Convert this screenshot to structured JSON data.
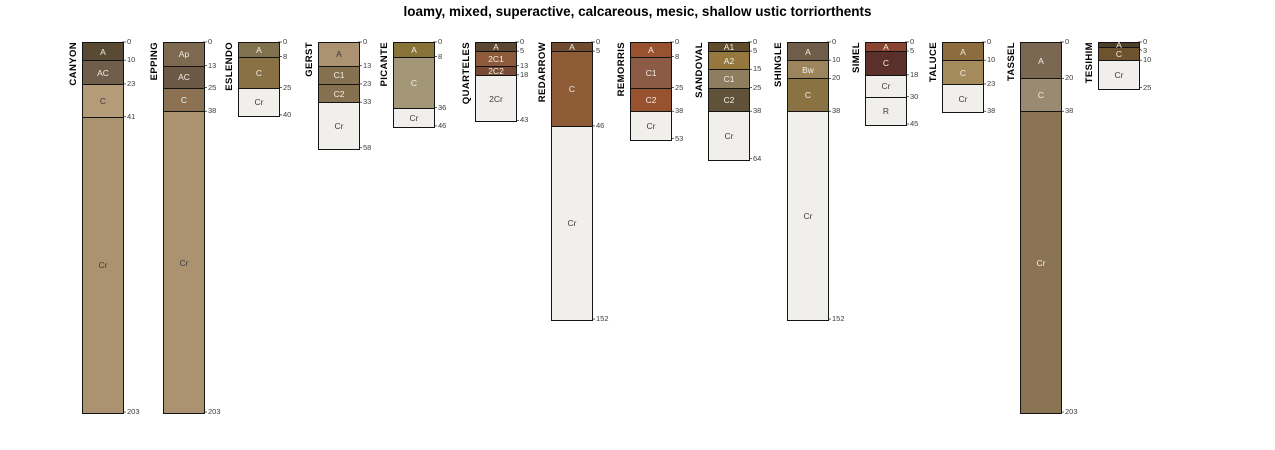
{
  "title": "loamy, mixed, superactive, calcareous, mesic, shallow ustic torriorthents",
  "chart_data": {
    "type": "bar",
    "subtype": "soil-horizon-depth-columns",
    "title": "loamy, mixed, superactive, calcareous, mesic, shallow ustic torriorthents",
    "ylabel": "depth, cm",
    "axis": {
      "top_y": 42,
      "px_per_cm": 1.8227,
      "bar_width": 40,
      "min_label_gap": 9
    },
    "profiles": [
      {
        "name": "CANYON",
        "x": 82,
        "horizons": [
          {
            "label": "A",
            "top": 0,
            "bottom": 10,
            "color": "#594a33",
            "text": "#f2efe9"
          },
          {
            "label": "AC",
            "top": 10,
            "bottom": 23,
            "color": "#6f5e49",
            "text": "#f2efe9"
          },
          {
            "label": "C",
            "top": 23,
            "bottom": 41,
            "color": "#b59c79",
            "text": "#3c3c3c"
          },
          {
            "label": "Cr",
            "top": 41,
            "bottom": 203,
            "color": "#ab9270",
            "text": "#3c3c3c"
          }
        ]
      },
      {
        "name": "EPPING",
        "x": 163,
        "horizons": [
          {
            "label": "Ap",
            "top": 0,
            "bottom": 13,
            "color": "#7d6850",
            "text": "#f2efe9"
          },
          {
            "label": "AC",
            "top": 13,
            "bottom": 25,
            "color": "#6b5845",
            "text": "#f2efe9"
          },
          {
            "label": "C",
            "top": 25,
            "bottom": 38,
            "color": "#8c7253",
            "text": "#f2efe9"
          },
          {
            "label": "Cr",
            "top": 38,
            "bottom": 203,
            "color": "#ab9270",
            "text": "#3c3c3c"
          }
        ]
      },
      {
        "name": "ESLENDO",
        "x": 238,
        "horizons": [
          {
            "label": "A",
            "top": 0,
            "bottom": 8,
            "color": "#80714f",
            "text": "#f2efe9"
          },
          {
            "label": "C",
            "top": 8,
            "bottom": 25,
            "color": "#8a7045",
            "text": "#f2efe9"
          },
          {
            "label": "Cr",
            "top": 25,
            "bottom": 40,
            "color": "#f0efec",
            "text": "#3c3c3c"
          }
        ]
      },
      {
        "name": "GERST",
        "x": 318,
        "horizons": [
          {
            "label": "A",
            "top": 0,
            "bottom": 13,
            "color": "#ab9270",
            "text": "#3c3c3c"
          },
          {
            "label": "C1",
            "top": 13,
            "bottom": 23,
            "color": "#857050",
            "text": "#f2efe9"
          },
          {
            "label": "C2",
            "top": 23,
            "bottom": 33,
            "color": "#857050",
            "text": "#f2efe9"
          },
          {
            "label": "Cr",
            "top": 33,
            "bottom": 58,
            "color": "#f0efec",
            "text": "#3c3c3c"
          }
        ]
      },
      {
        "name": "PICANTE",
        "x": 393,
        "horizons": [
          {
            "label": "A",
            "top": 0,
            "bottom": 8,
            "color": "#877238",
            "text": "#f2efe9"
          },
          {
            "label": "C",
            "top": 8,
            "bottom": 36,
            "color": "#a39778",
            "text": "#f2efe9"
          },
          {
            "label": "Cr",
            "top": 36,
            "bottom": 46,
            "color": "#f0efec",
            "text": "#3c3c3c"
          }
        ]
      },
      {
        "name": "QUARTELES",
        "x": 475,
        "horizons": [
          {
            "label": "A",
            "top": 0,
            "bottom": 5,
            "color": "#5c4733",
            "text": "#f2efe9"
          },
          {
            "label": "2C1",
            "top": 5,
            "bottom": 13,
            "color": "#8d5a3b",
            "text": "#f2efe9"
          },
          {
            "label": "2C2",
            "top": 13,
            "bottom": 18,
            "color": "#774a34",
            "text": "#f2efe9"
          },
          {
            "label": "2Cr",
            "top": 18,
            "bottom": 43,
            "color": "#f0efec",
            "text": "#3c3c3c"
          }
        ]
      },
      {
        "name": "REDARROW",
        "x": 551,
        "horizons": [
          {
            "label": "A",
            "top": 0,
            "bottom": 5,
            "color": "#6f4c30",
            "text": "#f2efe9"
          },
          {
            "label": "C",
            "top": 5,
            "bottom": 46,
            "color": "#8d5c36",
            "text": "#f2efe9"
          },
          {
            "label": "Cr",
            "top": 46,
            "bottom": 152,
            "color": "#f0efec",
            "text": "#3c3c3c"
          }
        ]
      },
      {
        "name": "REMORRIS",
        "x": 630,
        "horizons": [
          {
            "label": "A",
            "top": 0,
            "bottom": 8,
            "color": "#98522f",
            "text": "#f2efe9"
          },
          {
            "label": "C1",
            "top": 8,
            "bottom": 25,
            "color": "#8c5b45",
            "text": "#f2efe9"
          },
          {
            "label": "C2",
            "top": 25,
            "bottom": 38,
            "color": "#98522f",
            "text": "#f2efe9"
          },
          {
            "label": "Cr",
            "top": 38,
            "bottom": 53,
            "color": "#f0efec",
            "text": "#3c3c3c"
          }
        ]
      },
      {
        "name": "SANDOVAL",
        "x": 708,
        "horizons": [
          {
            "label": "A1",
            "top": 0,
            "bottom": 5,
            "color": "#5f4c2a",
            "text": "#f2efe9"
          },
          {
            "label": "A2",
            "top": 5,
            "bottom": 15,
            "color": "#96783f",
            "text": "#f2efe9"
          },
          {
            "label": "C1",
            "top": 15,
            "bottom": 25,
            "color": "#8f7d60",
            "text": "#f2efe9"
          },
          {
            "label": "C2",
            "top": 25,
            "bottom": 38,
            "color": "#605139",
            "text": "#f2efe9"
          },
          {
            "label": "Cr",
            "top": 38,
            "bottom": 64,
            "color": "#f0efec",
            "text": "#3c3c3c"
          }
        ]
      },
      {
        "name": "SHINGLE",
        "x": 787,
        "horizons": [
          {
            "label": "A",
            "top": 0,
            "bottom": 10,
            "color": "#6f5d49",
            "text": "#f2efe9"
          },
          {
            "label": "Bw",
            "top": 10,
            "bottom": 20,
            "color": "#9c855c",
            "text": "#f2efe9"
          },
          {
            "label": "C",
            "top": 20,
            "bottom": 38,
            "color": "#8a7243",
            "text": "#f2efe9"
          },
          {
            "label": "Cr",
            "top": 38,
            "bottom": 152,
            "color": "#f0efec",
            "text": "#3c3c3c"
          }
        ]
      },
      {
        "name": "SIMEL",
        "x": 865,
        "horizons": [
          {
            "label": "A",
            "top": 0,
            "bottom": 5,
            "color": "#8a4530",
            "text": "#f2efe9"
          },
          {
            "label": "C",
            "top": 5,
            "bottom": 18,
            "color": "#5c302a",
            "text": "#f2efe9"
          },
          {
            "label": "Cr",
            "top": 18,
            "bottom": 30,
            "color": "#f0efec",
            "text": "#3c3c3c"
          },
          {
            "label": "R",
            "top": 30,
            "bottom": 45,
            "color": "#f0efec",
            "text": "#3c3c3c"
          }
        ]
      },
      {
        "name": "TALUCE",
        "x": 942,
        "horizons": [
          {
            "label": "A",
            "top": 0,
            "bottom": 10,
            "color": "#8d6c3f",
            "text": "#f2efe9"
          },
          {
            "label": "C",
            "top": 10,
            "bottom": 23,
            "color": "#a58a5c",
            "text": "#f2efe9"
          },
          {
            "label": "Cr",
            "top": 23,
            "bottom": 38,
            "color": "#f0efec",
            "text": "#3c3c3c"
          }
        ]
      },
      {
        "name": "TASSEL",
        "x": 1020,
        "horizons": [
          {
            "label": "A",
            "top": 0,
            "bottom": 20,
            "color": "#7a6852",
            "text": "#f2efe9"
          },
          {
            "label": "C",
            "top": 20,
            "bottom": 38,
            "color": "#9a8a72",
            "text": "#f2efe9"
          },
          {
            "label": "Cr",
            "top": 38,
            "bottom": 203,
            "color": "#8a7454",
            "text": "#f2efe9"
          }
        ]
      },
      {
        "name": "TESIHIM",
        "x": 1098,
        "horizons": [
          {
            "label": "A",
            "top": 0,
            "bottom": 3,
            "color": "#4f3d29",
            "text": "#f2efe9"
          },
          {
            "label": "C",
            "top": 3,
            "bottom": 10,
            "color": "#6f532e",
            "text": "#f2efe9"
          },
          {
            "label": "Cr",
            "top": 10,
            "bottom": 25,
            "color": "#f0efec",
            "text": "#3c3c3c"
          }
        ]
      }
    ]
  }
}
